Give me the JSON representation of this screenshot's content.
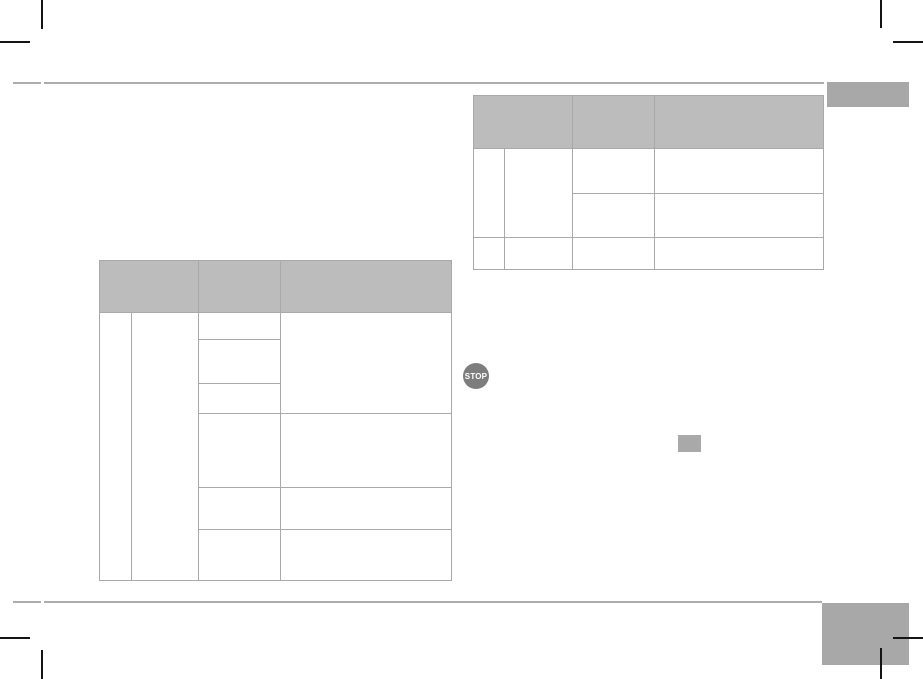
{
  "page": {
    "kind": "printed-manual-page",
    "background": "#ffffff"
  },
  "colors": {
    "table_header_fill": "#bcbcbc",
    "table_border": "#a9a9a9",
    "horizontal_rule": "#acacac",
    "corner_tab": "#a8a8a8",
    "stop_icon_fill": "#7d7d7d",
    "stop_icon_text_color": "#ffffff",
    "placeholder_box": "#a9a9a9",
    "crop_mark": "#141414"
  },
  "icons": {
    "stop": {
      "label": "STOP"
    }
  },
  "tables": {
    "top_right": {
      "header_cells": [
        "",
        "",
        ""
      ],
      "body_cells_empty": true,
      "columns": 4,
      "body_rows": 3
    },
    "left": {
      "header_cells": [
        "",
        "",
        ""
      ],
      "body_cells_empty": true,
      "columns": 4,
      "body_rows": 6
    }
  }
}
